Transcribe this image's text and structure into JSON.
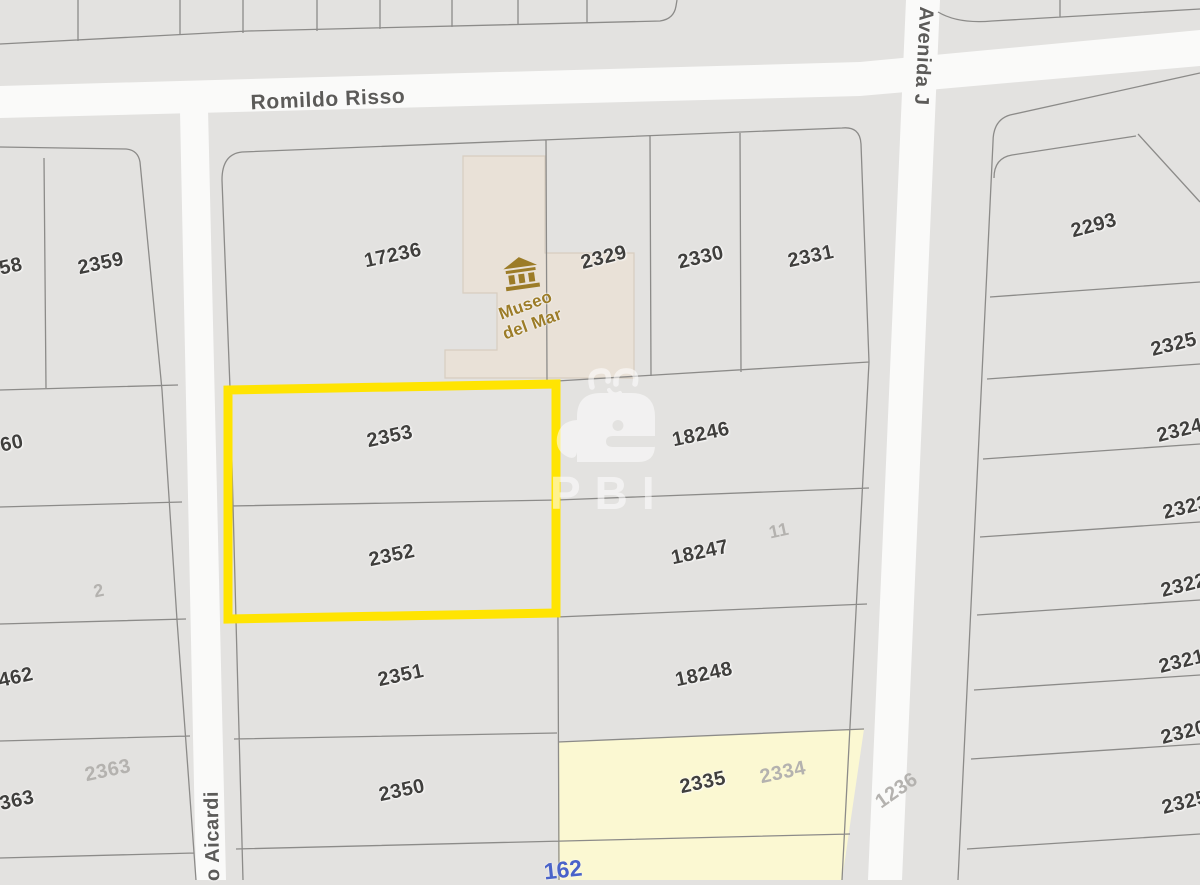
{
  "app": {
    "view": "cadastral-parcel-map"
  },
  "streets": {
    "romildo": "Romildo Risso",
    "avenida": "Avenida J",
    "aicardi": "o Aicardi"
  },
  "landmark": {
    "museum_line1": "Museo",
    "museum_line2": "del Mar"
  },
  "watermark": {
    "text": "PBI"
  },
  "highlight": {
    "parcels": [
      "2353",
      "2352"
    ],
    "outline_color": "#ffe402"
  },
  "parcel_labels": {
    "museum_block": [
      "17236",
      "2329",
      "2330",
      "2331"
    ],
    "left_column": [
      "58",
      "2359",
      "60",
      "2",
      "462",
      "2363",
      "363"
    ],
    "center_column": [
      "2353",
      "2352",
      "2351",
      "2350"
    ],
    "mid_right_column": [
      "18246",
      "18247",
      "11",
      "18248",
      "2335",
      "2334"
    ],
    "right_column": [
      "2293",
      "2325",
      "2324",
      "2323",
      "2322",
      "2321",
      "2320",
      "2325"
    ],
    "street_numbers": [
      "1236",
      "162"
    ]
  },
  "colors": {
    "parcel_fill": "#e3e2e0",
    "road_fill": "#fafaf9",
    "boundary_line": "#8c8b89",
    "museum_fill": "#e9e1d7",
    "museum_accent": "#9c7c28",
    "highlight_yellow": "#ffe402",
    "highlight_parcel_fill": "#fbf8d2",
    "dark_label": "#403f3d",
    "faint_label": "#b4b2af",
    "blue_label": "#4a63c9"
  }
}
